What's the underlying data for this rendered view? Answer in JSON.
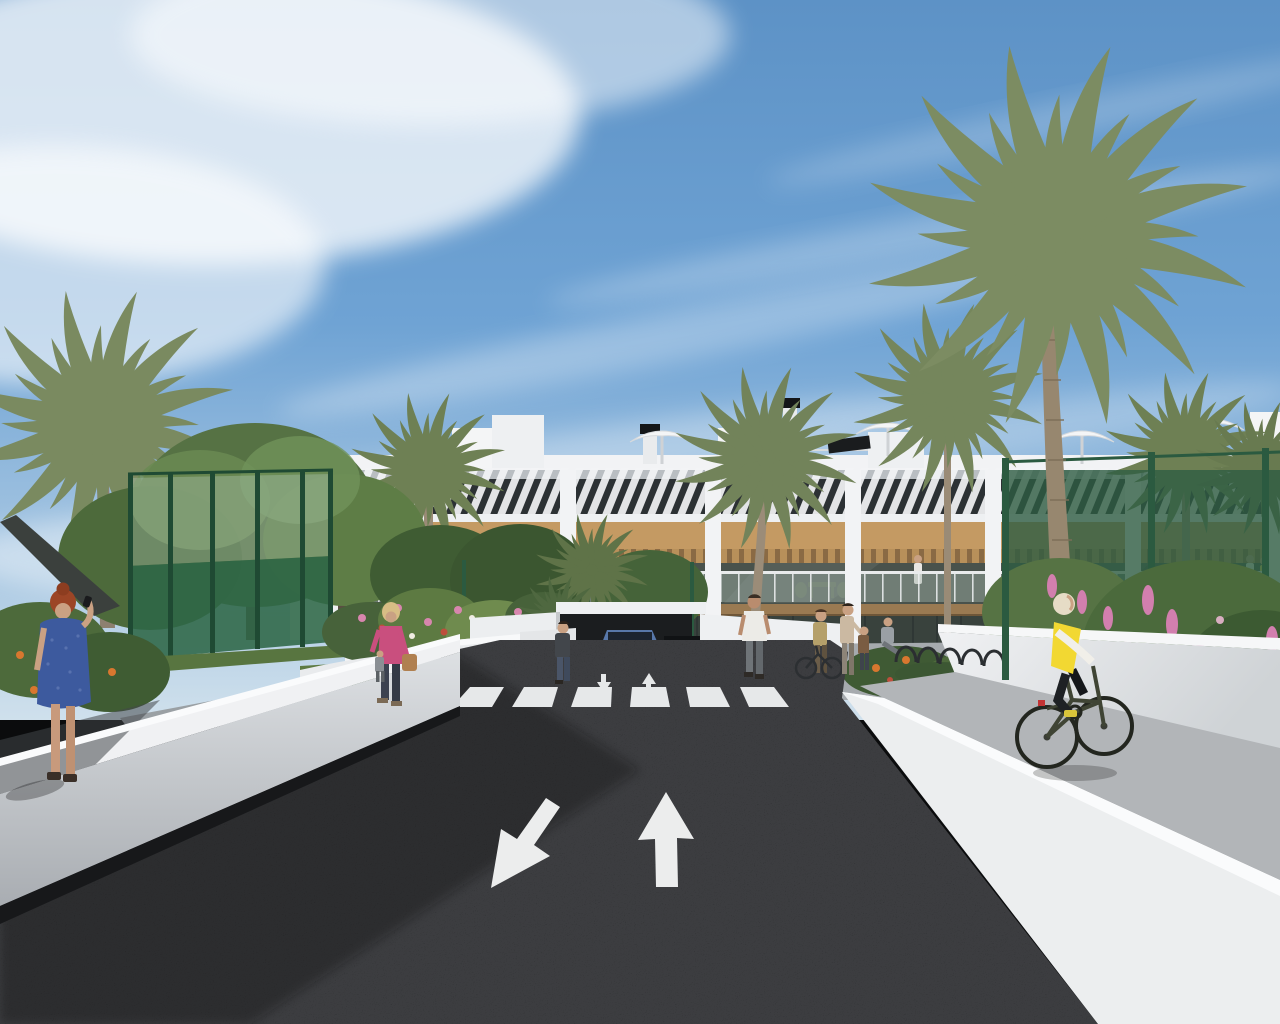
{
  "scene": {
    "title": "Residential complex exterior 3D render",
    "render_style": "3d architectural visualization",
    "setting": "modern two-storey white apartment building with wood cladding, palm trees and a landscaped entrance road",
    "sky": "blue sky with wispy white clouds",
    "time_of_day": "day"
  },
  "colors": {
    "sky_top": "#5d92c6",
    "sky_mid": "#6fa3d4",
    "sky_horizon": "#cfe0ec",
    "cloud_white": "#ffffff",
    "building_white": "#f2f3f5",
    "louver_glass": "#2c3134",
    "wood_accent": "#c49a63",
    "pergola_wood": "#8a6a44",
    "terrace_interior": "#49524c",
    "slab_wood": "#9a7a52",
    "asphalt": "#26272a",
    "marking_white": "#eceded",
    "path_gray": "#b2b5b8",
    "curb_white": "#eceeef",
    "wall_light": "#e8eaec",
    "grass_green": "#5d7a42",
    "palm_green": "#7a8a60",
    "palm_green_dark": "#6e8054",
    "fence_green": "#2e5d42",
    "flower_orange": "#d8772f",
    "flower_pink": "#d27fae",
    "dress_blue": "#3d5a9e",
    "hair_red": "#9c4526",
    "jacket_pink": "#c94f7e",
    "vest_yellow": "#f2d832",
    "car_blue": "#4a6fa3",
    "skin": "#c9a183"
  },
  "road": {
    "surface": "dark asphalt",
    "lane_arrow_count": 2,
    "lane_arrows": [
      {
        "id": "left-lane-arrow",
        "direction": "toward-viewer-left"
      },
      {
        "id": "right-lane-arrow",
        "direction": "away-from-viewer"
      }
    ],
    "crosswalk_stripe_count": 6,
    "mini_arrow_count": 2,
    "mini_arrows": [
      {
        "id": "mini-arrow-down",
        "direction": "toward-viewer"
      },
      {
        "id": "mini-arrow-up",
        "direction": "away-from-viewer"
      }
    ]
  },
  "building": {
    "floors": 2,
    "style": "white facade with diagonal louver slats, wood band and glass balustrade terraces",
    "rooftop_items": [
      "parasols",
      "chimneys",
      "solar-panel",
      "stair-bulkheads"
    ],
    "terraces": "wood pergolas over glass-fronted terraces with outdoor furniture"
  },
  "vegetation": {
    "palm_count": 9,
    "tree_clusters_left": 4,
    "flower_colors": [
      "orange",
      "pink",
      "red",
      "white"
    ]
  },
  "fences": {
    "left": "green padel-court enclosure with dark green panels and posts",
    "right": "green mesh fence with posts"
  },
  "people": [
    {
      "id": "woman-blue-dress",
      "description": "red-haired woman in a blue dress talking on the phone, left foreground wall"
    },
    {
      "id": "woman-pink-jacket",
      "description": "blonde woman in pink jacket with tan handbag walking on the left path"
    },
    {
      "id": "man-white-shirt",
      "description": "man in white t-shirt walking away on the center-left path"
    },
    {
      "id": "woman-by-planter",
      "description": "woman in dark top standing by the white planter left of the driveway"
    },
    {
      "id": "woman-with-bicycle",
      "description": "woman standing with a bicycle near the bike racks"
    },
    {
      "id": "adult-with-child",
      "description": "adult with a child on the right plaza"
    },
    {
      "id": "seated-person",
      "description": "person seated near the right planter"
    },
    {
      "id": "cyclist-yellow-vest",
      "description": "cyclist in yellow vest riding on the right-hand paved path"
    },
    {
      "id": "distant-walker",
      "description": "small distant figure on the left garden path"
    },
    {
      "id": "balcony-residents",
      "description": "small figures standing on the upper terraces"
    }
  ],
  "vehicles": [
    {
      "id": "blue-suv",
      "description": "blue SUV parked at the central garage entrance facing the viewer"
    }
  ]
}
